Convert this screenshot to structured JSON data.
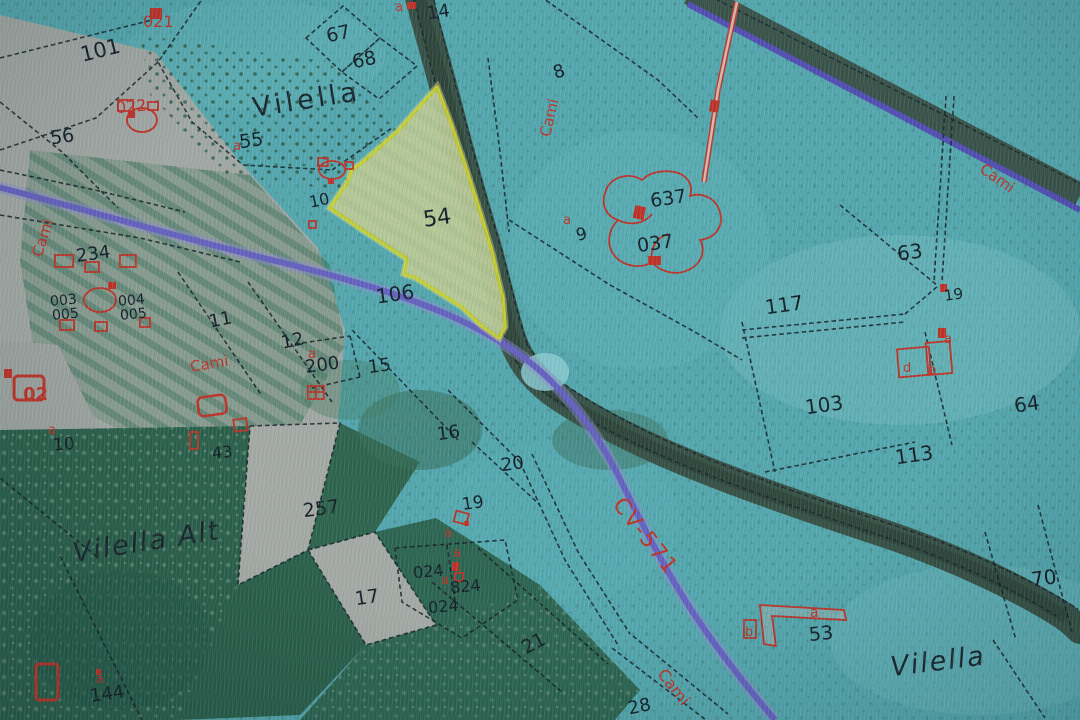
{
  "map": {
    "selected_parcel": "54",
    "place_names": {
      "vilella_top": "Vilella",
      "vilella_alt": "Vilella Alt",
      "vilella_se": "Vilella"
    },
    "road": {
      "label": "CV-571"
    },
    "path_label": "Cami",
    "colors": {
      "terrain_teal": "#5db9c1",
      "photo_gray": "#b3bab6",
      "forest_green": "#2f6a53",
      "ravine_dark": "#3d5a4e",
      "road_purple": "#6f6cd4",
      "highlight_stroke": "#eaee2c",
      "highlight_fill": "#d9e8ac",
      "annotation_red": "#d2392d",
      "parcel_line": "#16242c"
    },
    "parcel_labels": {
      "p101": "101",
      "p67": "67",
      "p68": "68",
      "p14": "14",
      "p8": "8",
      "p55": "55",
      "p56": "56",
      "p54": "54",
      "p106": "106",
      "p10n": "10",
      "p9": "9",
      "p117": "117",
      "p103": "103",
      "p113": "113",
      "p63": "63",
      "p19e": "19",
      "p64": "64",
      "p70": "70",
      "p53": "53",
      "p234": "234",
      "p11": "11",
      "p12": "12",
      "p200": "200",
      "p15": "15",
      "p16": "16",
      "p20": "20",
      "p19": "19",
      "p257": "257",
      "p17": "17",
      "p21": "21",
      "p28": "28",
      "p43": "43",
      "p10w": "10",
      "p144": "144"
    },
    "building_labels": {
      "b021": "021",
      "b022": "022",
      "b637": "637",
      "b037": "037",
      "b024a": "024",
      "b824": "824",
      "b024b": "024",
      "b003": "003",
      "b004": "004",
      "b005": "005",
      "b005b": "005",
      "b02": "02"
    },
    "letters": {
      "a": "a",
      "b": "b",
      "d": "d"
    }
  }
}
